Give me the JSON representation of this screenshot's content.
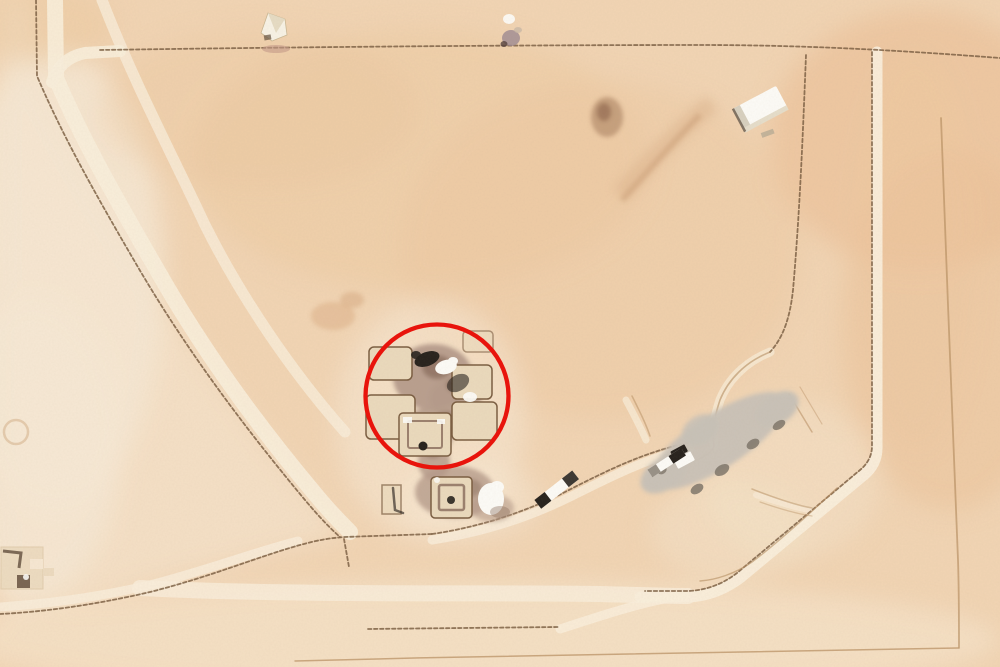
{
  "scene": {
    "type": "satellite-aerial-photograph",
    "width_px": 1000,
    "height_px": 667,
    "description": "Overhead desert satellite view: tan sand crossed by thin access roads and light berm tracks; a central cluster of square bermed pads with dark and white equipment is highlighted by a red circle annotation; a gray vehicle pad sits inside an angled road enclosure to the east; small white structures sit along the north edge, northeast corner and southwest corner."
  },
  "annotation": {
    "shape": "circle",
    "cx": 437,
    "cy": 396,
    "r": 71.5,
    "stroke_width": 4.3
  },
  "palette": {
    "sand_base": "#f2d5b4",
    "sand_pale": "#f7e9d5",
    "sand_pale2": "#f6e4ca",
    "sand_orange": "#eec9a0",
    "sand_deep": "#ecc096",
    "track_light": "#faefdc",
    "road_dark": "#7c6044",
    "road_faint": "#b68d60",
    "pad_fill": "#ebdabd",
    "pad_stroke": "#7a5d41",
    "ground_brown": "#b59b8b",
    "ground_dark": "#8d7060",
    "object_black": "#26211c",
    "object_white": "#fdfcf8",
    "gray_pad": "#c9c2b8",
    "gray_pad_dark": "#7e756a",
    "mauve": "#9e8a92",
    "stain_brown": "#aa8262",
    "stain_orange": "#dcae85",
    "annotation_red": "#e8140c"
  }
}
